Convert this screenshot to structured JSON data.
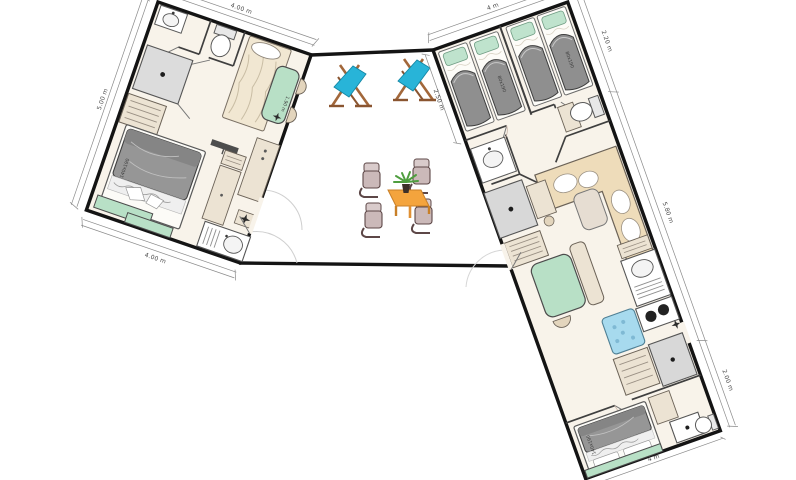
{
  "plan": {
    "type": "mobile-home-floor-plan",
    "layout": "two angled units joined by central terrace"
  },
  "dimensions": {
    "left_top": "4.00 m",
    "left_side": "5.00 m",
    "left_bottom": "4.00 m",
    "left_wall": "1.90 m",
    "left_bed": "140x190",
    "right_top": "4 m",
    "right_left": "2.50 m",
    "right_side_top": "2.20 m",
    "right_side_mid": "5.80 m",
    "right_side_bottom": "2.00 m",
    "right_bottom": "4 m",
    "right_bed_single_a": "80x190",
    "right_bed_single_b": "80x190",
    "right_bed_master": "140x190"
  },
  "colors": {
    "wall": "#141414",
    "inner_wall": "#3f3f3f",
    "floor": "#f8f3ea",
    "mint": "#b8e0c6",
    "beige_furniture": "#ece3d3",
    "sofa_beige": "#eedcba",
    "blanket_gray": "#949494",
    "pillow_green": "#bfe3cd",
    "appliance_gray": "#d8d8d8",
    "washer_blue": "#a7daee",
    "deckchair_blue": "#28b4d8",
    "wood_brown": "#a2673a",
    "table_orange": "#f4a43d",
    "chair_mauve": "#cbb9b9",
    "chair_frame": "#5d4747",
    "plant_green": "#4f9e3f",
    "door_arc": "#cfcfcf",
    "dim_line": "#8a8a8a"
  },
  "units": {
    "left": {
      "name": "left-unit",
      "rooms": [
        "bathroom",
        "bedroom-single",
        "dining",
        "bedroom-double",
        "kitchen"
      ],
      "furniture": [
        "washbasin",
        "toilet",
        "shower",
        "dresser",
        "single-bed",
        "dining-table",
        "chairs",
        "double-bed",
        "bench",
        "tv",
        "wardrobe",
        "kitchen-sink",
        "ceiling-light"
      ]
    },
    "right": {
      "name": "right-unit",
      "rooms": [
        "kids-bedroom-1",
        "kids-bedroom-2",
        "bathroom",
        "wc",
        "living-room",
        "kitchen",
        "master-bedroom"
      ],
      "furniture": [
        "single-bed",
        "single-bed",
        "single-bed",
        "single-bed",
        "washbasin",
        "toilet",
        "corner-sofa",
        "coffee-table",
        "wardrobe",
        "desk",
        "dresser",
        "dining-table",
        "bench",
        "shelf",
        "kitchen-sink",
        "cooktop",
        "dishwasher",
        "fridge",
        "double-bed",
        "shower",
        "toilet",
        "ceiling-light"
      ]
    },
    "terrace": {
      "name": "terrace",
      "furniture": [
        "deck-chair",
        "deck-chair",
        "garden-table",
        "garden-chairs",
        "potted-plant"
      ]
    }
  }
}
